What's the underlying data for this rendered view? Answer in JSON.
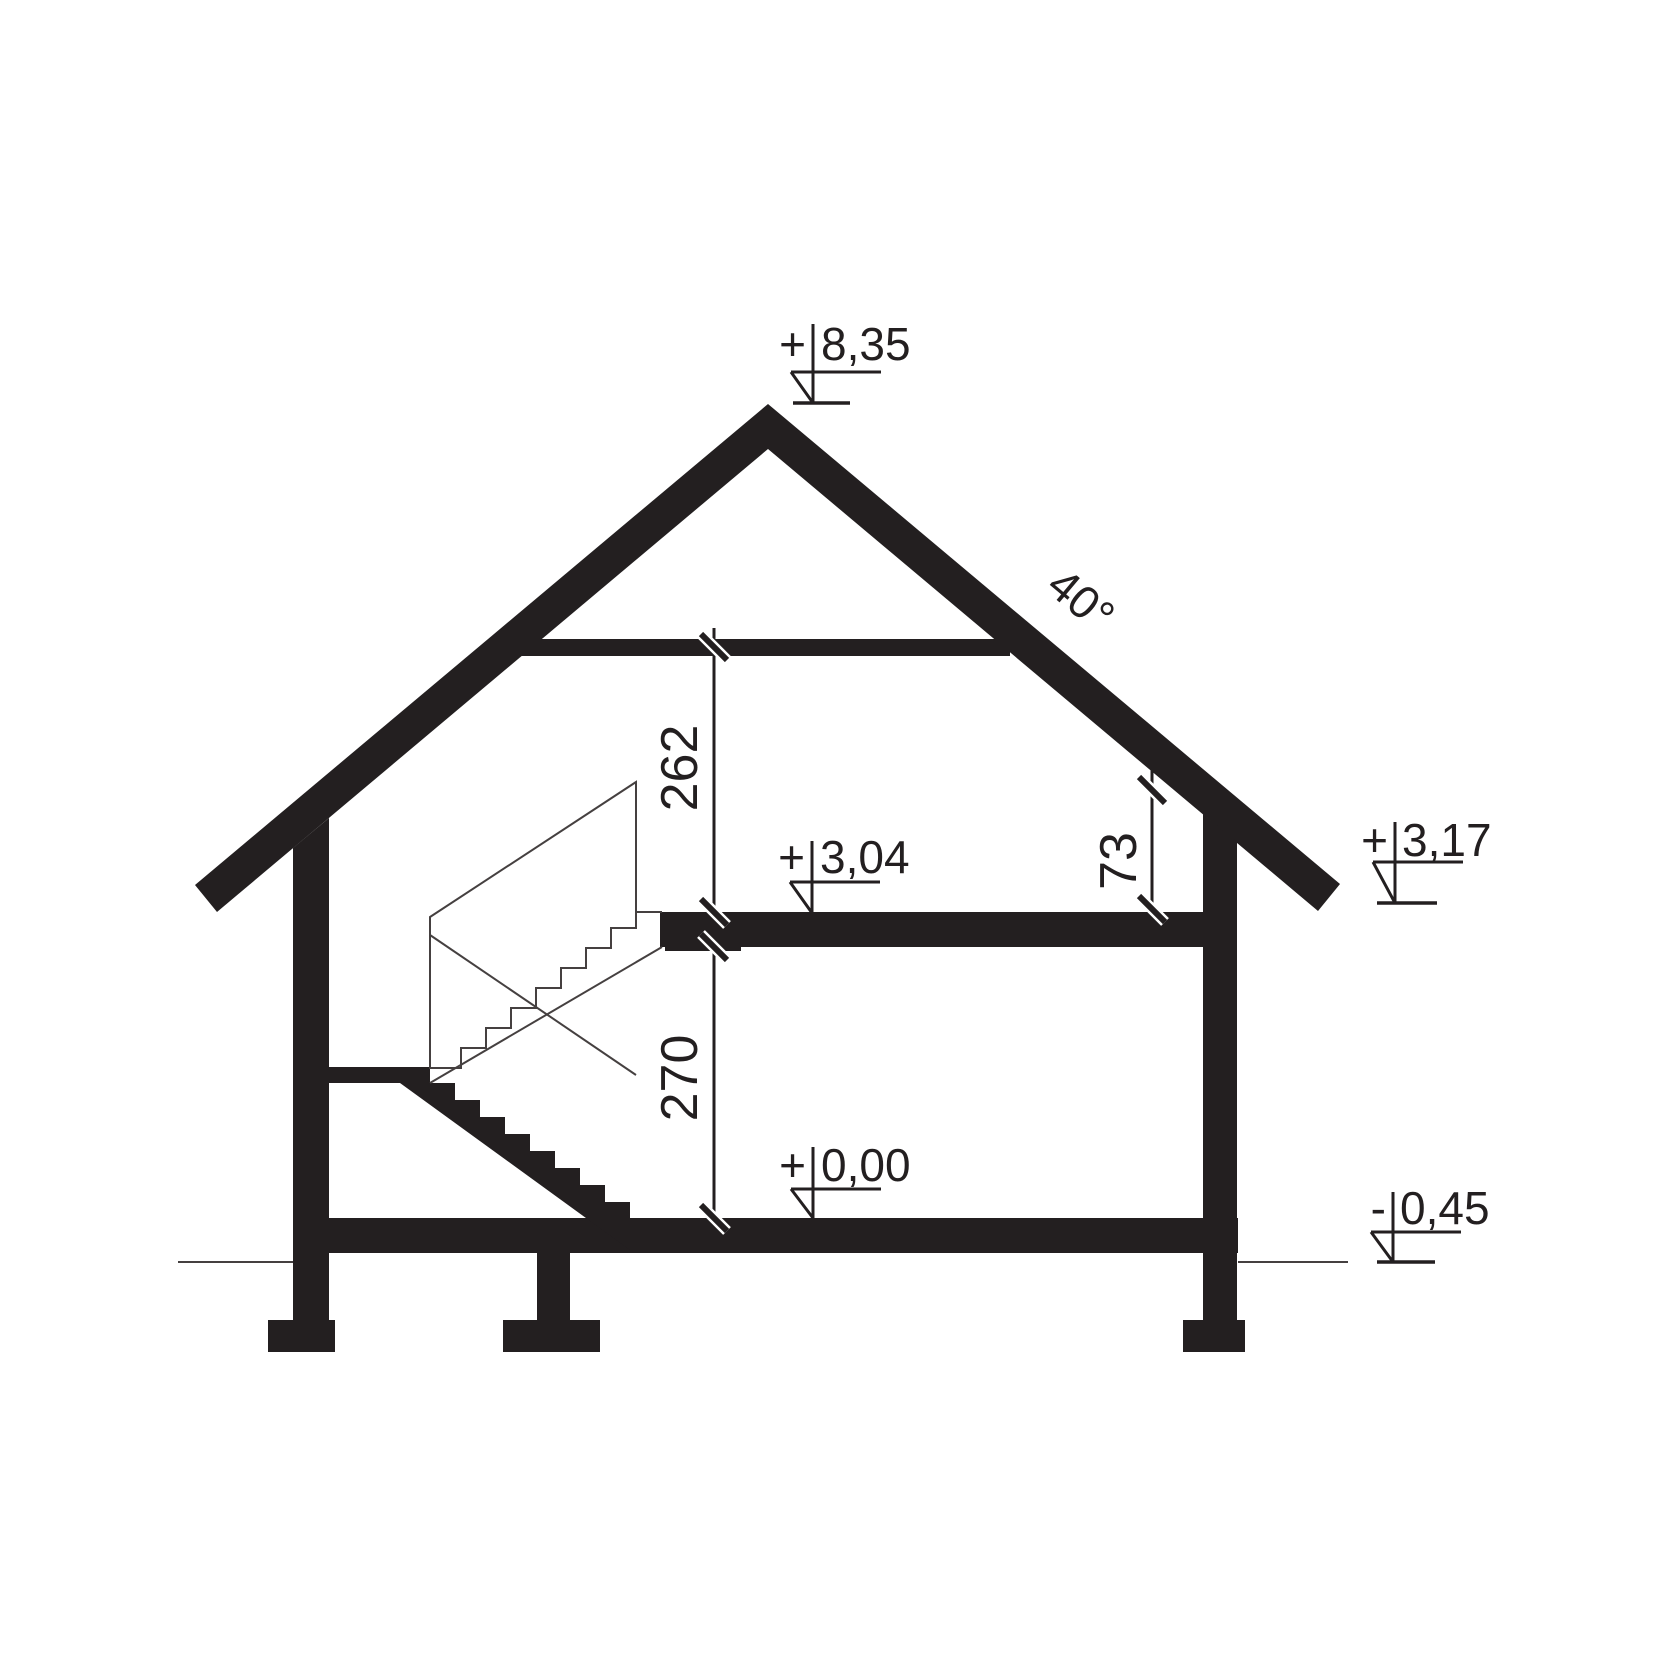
{
  "levels": {
    "ridge": {
      "sign": "+",
      "value": "8,35"
    },
    "attic_floor": {
      "sign": "+",
      "value": "3,04"
    },
    "eaves": {
      "sign": "+",
      "value": "3,17"
    },
    "ground_floor": {
      "sign": "+",
      "value": "0,00"
    },
    "terrain": {
      "sign": "-",
      "value": "0,45"
    }
  },
  "dimensions": {
    "attic_room_height": "262",
    "ground_room_height": "270",
    "knee_wall_height": "73",
    "roof_pitch": "40°"
  },
  "colors": {
    "ink": "#231f20",
    "thin_line": "#454040",
    "background": "#ffffff"
  }
}
